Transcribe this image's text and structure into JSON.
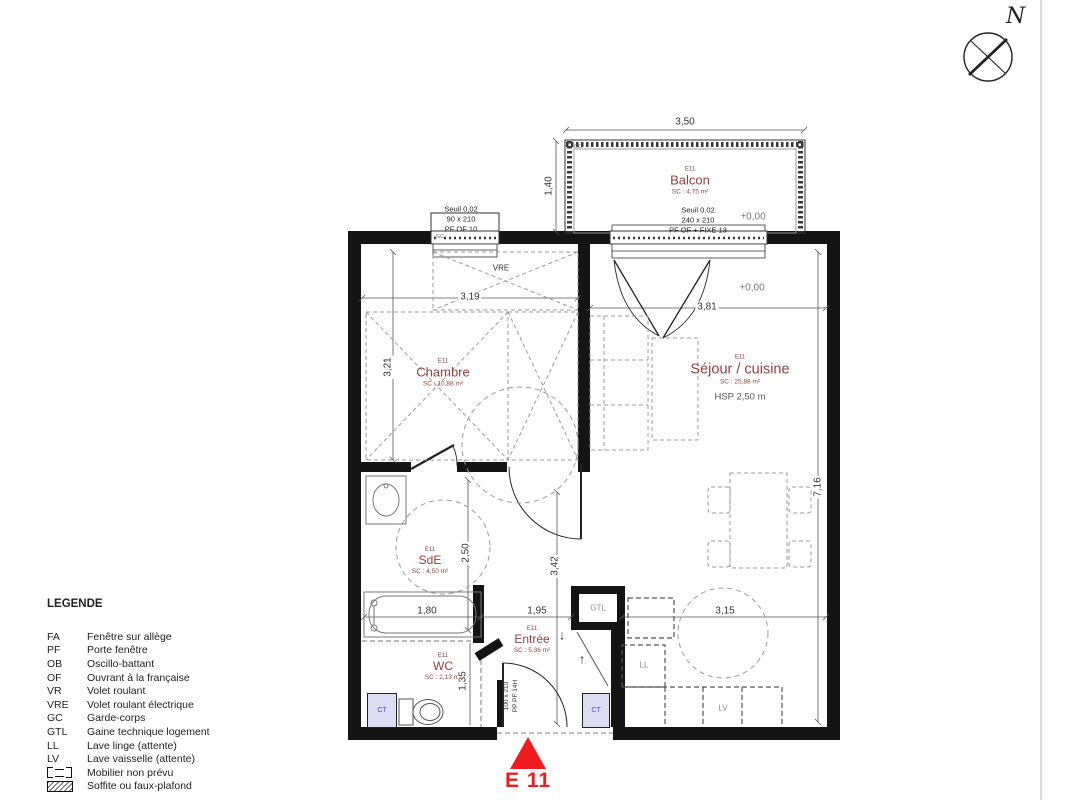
{
  "marker": {
    "label": "E 11"
  },
  "compass": {
    "north": "N"
  },
  "legend": {
    "title": "LEGENDE",
    "items": [
      {
        "abbr": "FA",
        "label": "Fenêtre sur allège"
      },
      {
        "abbr": "PF",
        "label": "Porte fenêtre"
      },
      {
        "abbr": "OB",
        "label": "Oscillo-battant"
      },
      {
        "abbr": "OF",
        "label": "Ouvrant à la française"
      },
      {
        "abbr": "VR",
        "label": "Volet roulant"
      },
      {
        "abbr": "VRE",
        "label": "Volet roulant électrique"
      },
      {
        "abbr": "GC",
        "label": "Garde-corps"
      },
      {
        "abbr": "GTL",
        "label": "Gaine technique logement"
      },
      {
        "abbr": "LL",
        "label": "Lave linge (attente)"
      },
      {
        "abbr": "LV",
        "label": "Lave vaisselle (attente)"
      }
    ],
    "mobilier_label": "Mobilier non prévu",
    "soffite_label": "Soffite ou faux-plafond"
  },
  "rooms": {
    "balcon": {
      "code": "E11",
      "name": "Balcon",
      "area": "SC : 4,75 m²"
    },
    "chambre": {
      "code": "E11",
      "name": "Chambre",
      "area": "SC : 10,88 m²"
    },
    "sejour": {
      "code": "E11",
      "name": "Séjour / cuisine",
      "area": "SC : 25,88 m²",
      "hsp": "HSP 2,50 m"
    },
    "sde": {
      "code": "E11",
      "name": "SdE",
      "area": "SC : 4,50 m²"
    },
    "entree": {
      "code": "E11",
      "name": "Entrée",
      "area": "SC : 5,36 m²"
    },
    "wc": {
      "code": "E11",
      "name": "WC",
      "area": "SC : 2,13 m²"
    }
  },
  "openings": {
    "chambre_window": {
      "l1": "Seuil 0,02",
      "l2": "90 x 210",
      "l3": "PF OF 10"
    },
    "balcon_door": {
      "l1": "Seuil 0,02",
      "l2": "240 x 210",
      "l3": "PF OF + FIXE 13"
    },
    "entry_door": {
      "l1": "100 x 210",
      "l2": "PP PF 14H"
    }
  },
  "levels": {
    "balcon": "+0,00",
    "sejour": "+0,00"
  },
  "dims": {
    "balcon_w": "3,50",
    "balcon_d": "1,40",
    "chambre_w": "3,19",
    "chambre_h": "3,21",
    "sejour_w": "3,81",
    "plan_h": "7,16",
    "sde_h": "2,50",
    "bath_w": "1,80",
    "entree_w": "1,95",
    "entree_h": "3,42",
    "wc_h": "1,35",
    "kitchen_w": "3,15"
  },
  "tags": {
    "vre": "VRE",
    "gc_balcon": "GC",
    "gc_window": "GC",
    "gtl": "GTL",
    "ll": "LL",
    "lv": "LV",
    "ct_left": "CT",
    "ct_right": "CT"
  },
  "icons": {
    "arrow_down": "↓",
    "arrow_up": "↑"
  },
  "colors": {
    "room_label": "#94403c",
    "marker": "#ee1c1c",
    "wall": "#141414",
    "ct_fill": "#dcdcf2",
    "ct_text": "#4050c0"
  }
}
